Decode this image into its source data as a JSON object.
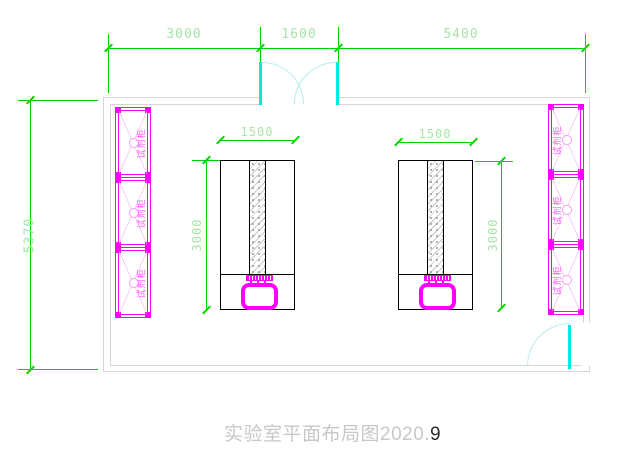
{
  "title": {
    "text": "实验室平面布局图2020.",
    "suffix": "9"
  },
  "dims": {
    "top1": "3000",
    "top2": "1600",
    "top3": "5400",
    "left": "5370",
    "bench_width": "1500",
    "bench_height": "3000"
  },
  "cabinets": {
    "label": "试剂柜"
  },
  "colors": {
    "dim_line": "#00d400",
    "dim_text": "#a8e4a8",
    "cabinet": "#ff00ff",
    "cabinet_text": "#ff55ff",
    "wall": "#d6d6d6",
    "door_leaf": "#00e8e8",
    "door_arc": "#b8ecf0",
    "bench_line": "#000000",
    "title_text": "#c8c8c8",
    "title_suffix": "#2b2b2b"
  }
}
